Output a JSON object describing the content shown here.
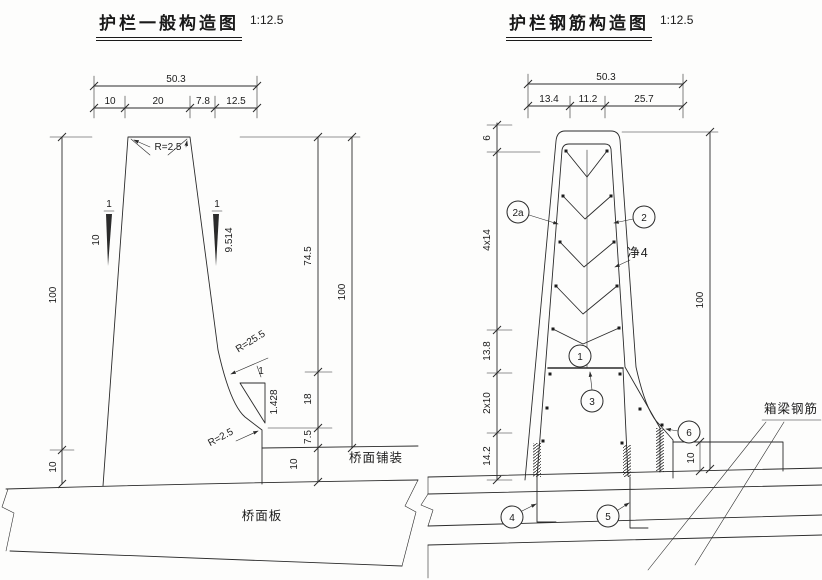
{
  "left": {
    "title": "护栏一般构造图",
    "scale": "1:12.5",
    "dim_total": "50.3",
    "dim_segments": [
      "10",
      "20",
      "7.8",
      "12.5"
    ],
    "dim_height_left": "100",
    "dim_deck_left": "10",
    "dim_upper": "74.5",
    "dim_mid": "18",
    "dim_lower": "7.5",
    "dim_pavement": "10",
    "dim_height_right": "100",
    "radius_top": "R=2.5",
    "slope_left": {
      "rise": "1",
      "run": "10"
    },
    "slope_right": {
      "rise": "1",
      "run": "9.514"
    },
    "radius_mid": "R=25.5",
    "slope_toe": {
      "rise": "1",
      "run": "1.428"
    },
    "radius_toe": "R=2.5",
    "pavement_label": "桥面铺装",
    "deck_label": "桥面板"
  },
  "right": {
    "title": "护栏钢筋构造图",
    "scale": "1:12.5",
    "dim_total": "50.3",
    "dim_segments": [
      "13.4",
      "11.2",
      "25.7"
    ],
    "dim_left": [
      "6",
      "4x14",
      "13.8",
      "2x10",
      "14.2"
    ],
    "dim_height": "100",
    "dim_pavement": "10",
    "clear_cover": "净4",
    "girder_label": "箱梁钢筋",
    "callouts": {
      "c2a": "2a",
      "c2": "2",
      "c1": "1",
      "c3": "3",
      "c4": "4",
      "c5": "5",
      "c6": "6"
    }
  }
}
